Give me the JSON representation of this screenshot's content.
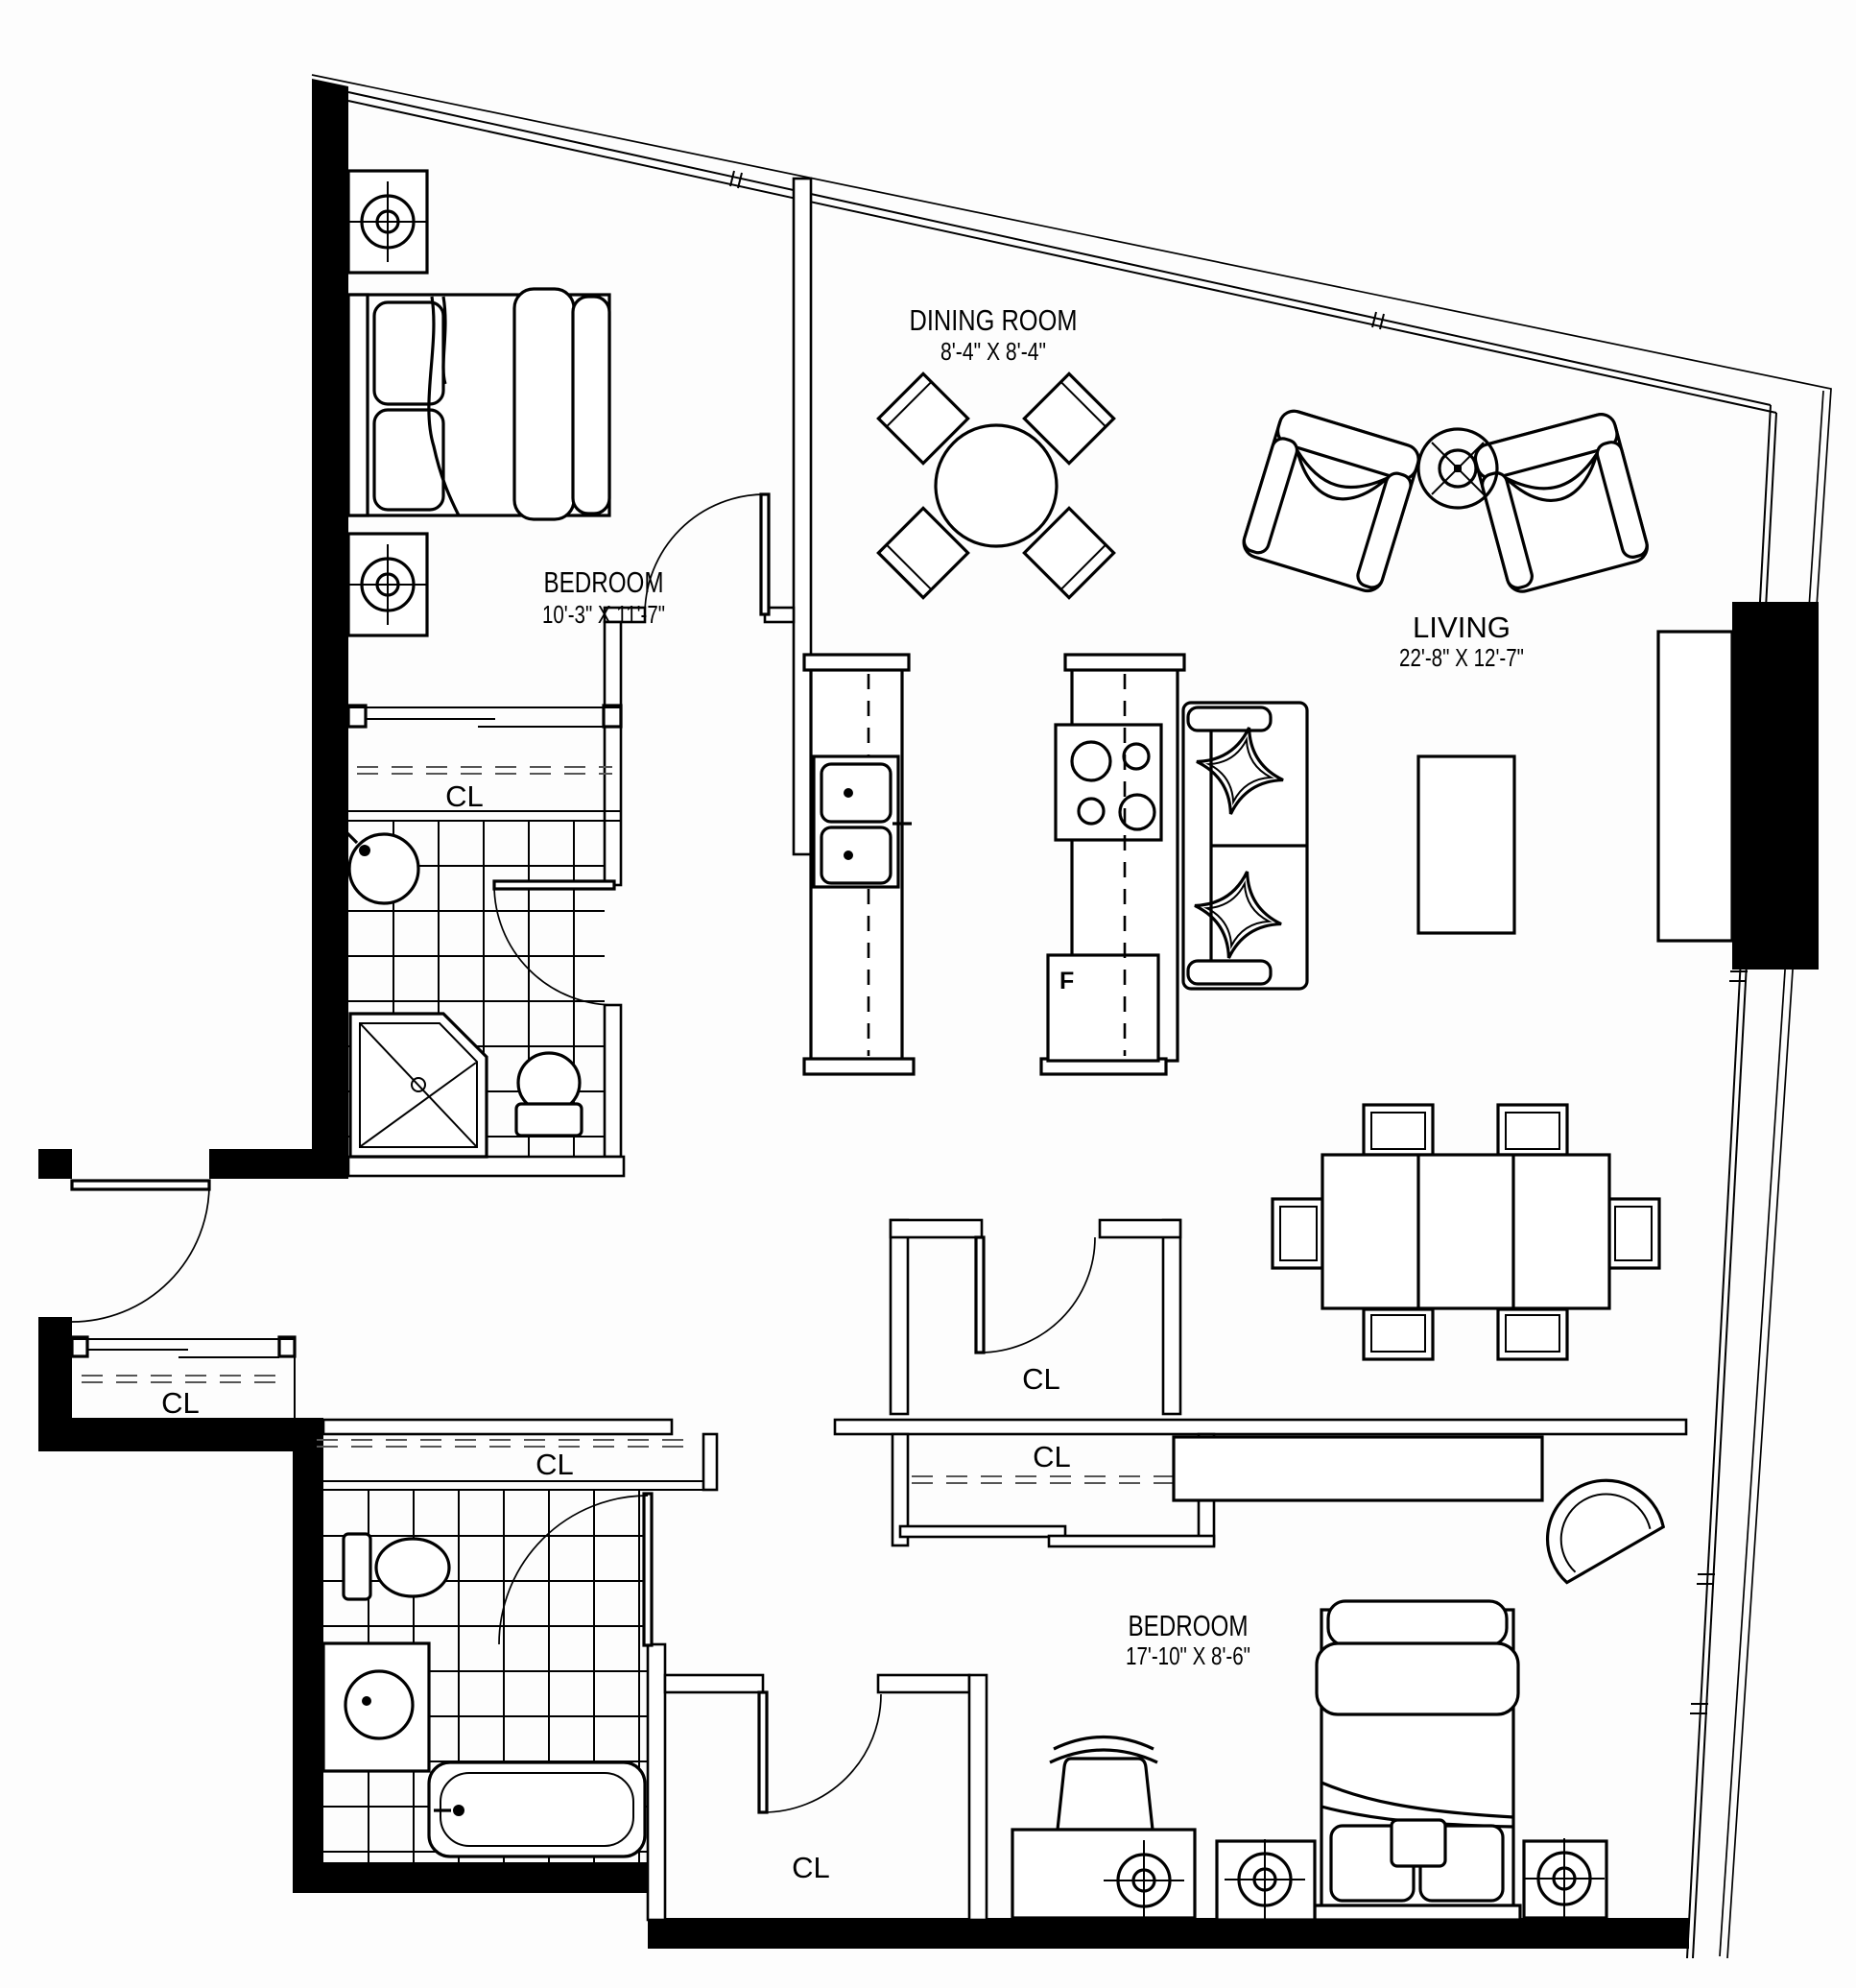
{
  "plan": {
    "rooms": [
      {
        "id": "bedroom-top",
        "name": "BEDROOM",
        "dims": "10'-3\" X 11'-7\""
      },
      {
        "id": "dining",
        "name": "DINING ROOM",
        "dims": "8'-4\" X 8'-4\""
      },
      {
        "id": "living",
        "name": "LIVING",
        "dims": "22'-8\" X 12'-7\""
      },
      {
        "id": "bedroom-bottom",
        "name": "BEDROOM",
        "dims": "17'-10\" X 8'-6\""
      }
    ],
    "closet_label": "CL",
    "fridge_label": "F",
    "colors": {
      "walls": "#000000",
      "background": "#ffffff",
      "lines": "#000000"
    }
  }
}
